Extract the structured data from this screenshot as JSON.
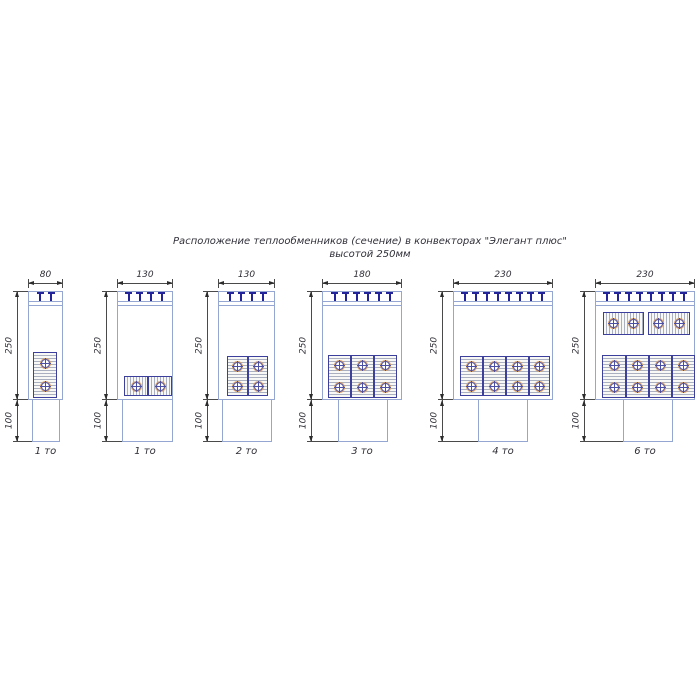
{
  "title": {
    "line1": "Расположение теплообменников (сечение) в конвекторах \"Элегант плюс\"",
    "line2": "высотой 250мм"
  },
  "drawing": {
    "height_dim_label": "250",
    "base_dim_label": "100",
    "diagrams": [
      {
        "width_dim": "80",
        "caption": "1 то",
        "clips": 2,
        "exchangers": [
          {
            "orient": "vertical",
            "tubes": 2
          }
        ]
      },
      {
        "width_dim": "130",
        "caption": "1 то",
        "clips": 4,
        "exchangers": [
          {
            "orient": "horizontal",
            "tubes": 1
          },
          {
            "orient": "horizontal",
            "tubes": 1
          }
        ]
      },
      {
        "width_dim": "130",
        "caption": "2 то",
        "clips": 4,
        "exchangers": [
          {
            "orient": "vertical",
            "tubes": 2
          },
          {
            "orient": "vertical",
            "tubes": 2
          }
        ]
      },
      {
        "width_dim": "180",
        "caption": "3 то",
        "clips": 6,
        "exchangers": [
          {
            "orient": "vertical",
            "tubes": 2
          },
          {
            "orient": "vertical",
            "tubes": 2
          },
          {
            "orient": "vertical",
            "tubes": 2
          }
        ]
      },
      {
        "width_dim": "230",
        "caption": "4 то",
        "clips": 8,
        "exchangers": [
          {
            "orient": "vertical",
            "tubes": 2
          },
          {
            "orient": "vertical",
            "tubes": 2
          },
          {
            "orient": "vertical",
            "tubes": 2
          },
          {
            "orient": "vertical",
            "tubes": 2
          }
        ]
      },
      {
        "width_dim": "230",
        "caption": "6 то",
        "clips": 8,
        "exchangers": [
          {
            "orient": "horizontal",
            "tubes": 2
          },
          {
            "orient": "horizontal",
            "tubes": 2
          },
          {
            "orient": "vertical",
            "tubes": 2
          },
          {
            "orient": "vertical",
            "tubes": 2
          },
          {
            "orient": "vertical",
            "tubes": 2
          },
          {
            "orient": "vertical",
            "tubes": 2
          }
        ]
      }
    ]
  }
}
